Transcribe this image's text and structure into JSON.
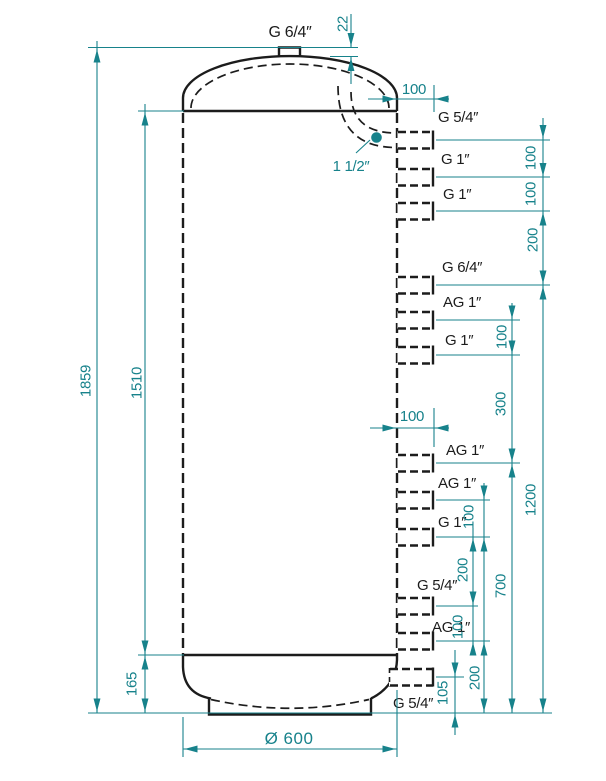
{
  "colors": {
    "outline": "#1c1c1c",
    "dimension": "#17828b",
    "background": "#ffffff"
  },
  "tank": {
    "top_connection_label": "G 6/4″",
    "internal_pipe_label": "1 1/2″",
    "connections": [
      {
        "label": "G 5/4″"
      },
      {
        "label": "G 1″"
      },
      {
        "label": "G 1″"
      },
      {
        "label": "G 6/4″"
      },
      {
        "label": "AG 1″"
      },
      {
        "label": "G 1″"
      },
      {
        "label": "AG 1″"
      },
      {
        "label": "AG 1″"
      },
      {
        "label": "G 1″"
      },
      {
        "label": "G 5/4″"
      },
      {
        "label": "AG 1″"
      },
      {
        "label": "G 5/4″"
      }
    ]
  },
  "dimensions": {
    "top_nozzle_height": "22",
    "nozzle_length_top": "100",
    "nozzle_length_mid": "100",
    "total_height": "1859",
    "body_height": "1510",
    "base_height": "165",
    "diameter": "Ø 600",
    "outer_chain": {
      "s1": "100",
      "s2": "100",
      "s3": "200",
      "s4": "1200"
    },
    "middle_chain": {
      "s1": "100",
      "s2": "300",
      "s3": "700"
    },
    "inner_chain": {
      "s1": "100",
      "s2": "200",
      "s3": "100",
      "s4": "200",
      "s5": "105"
    }
  }
}
